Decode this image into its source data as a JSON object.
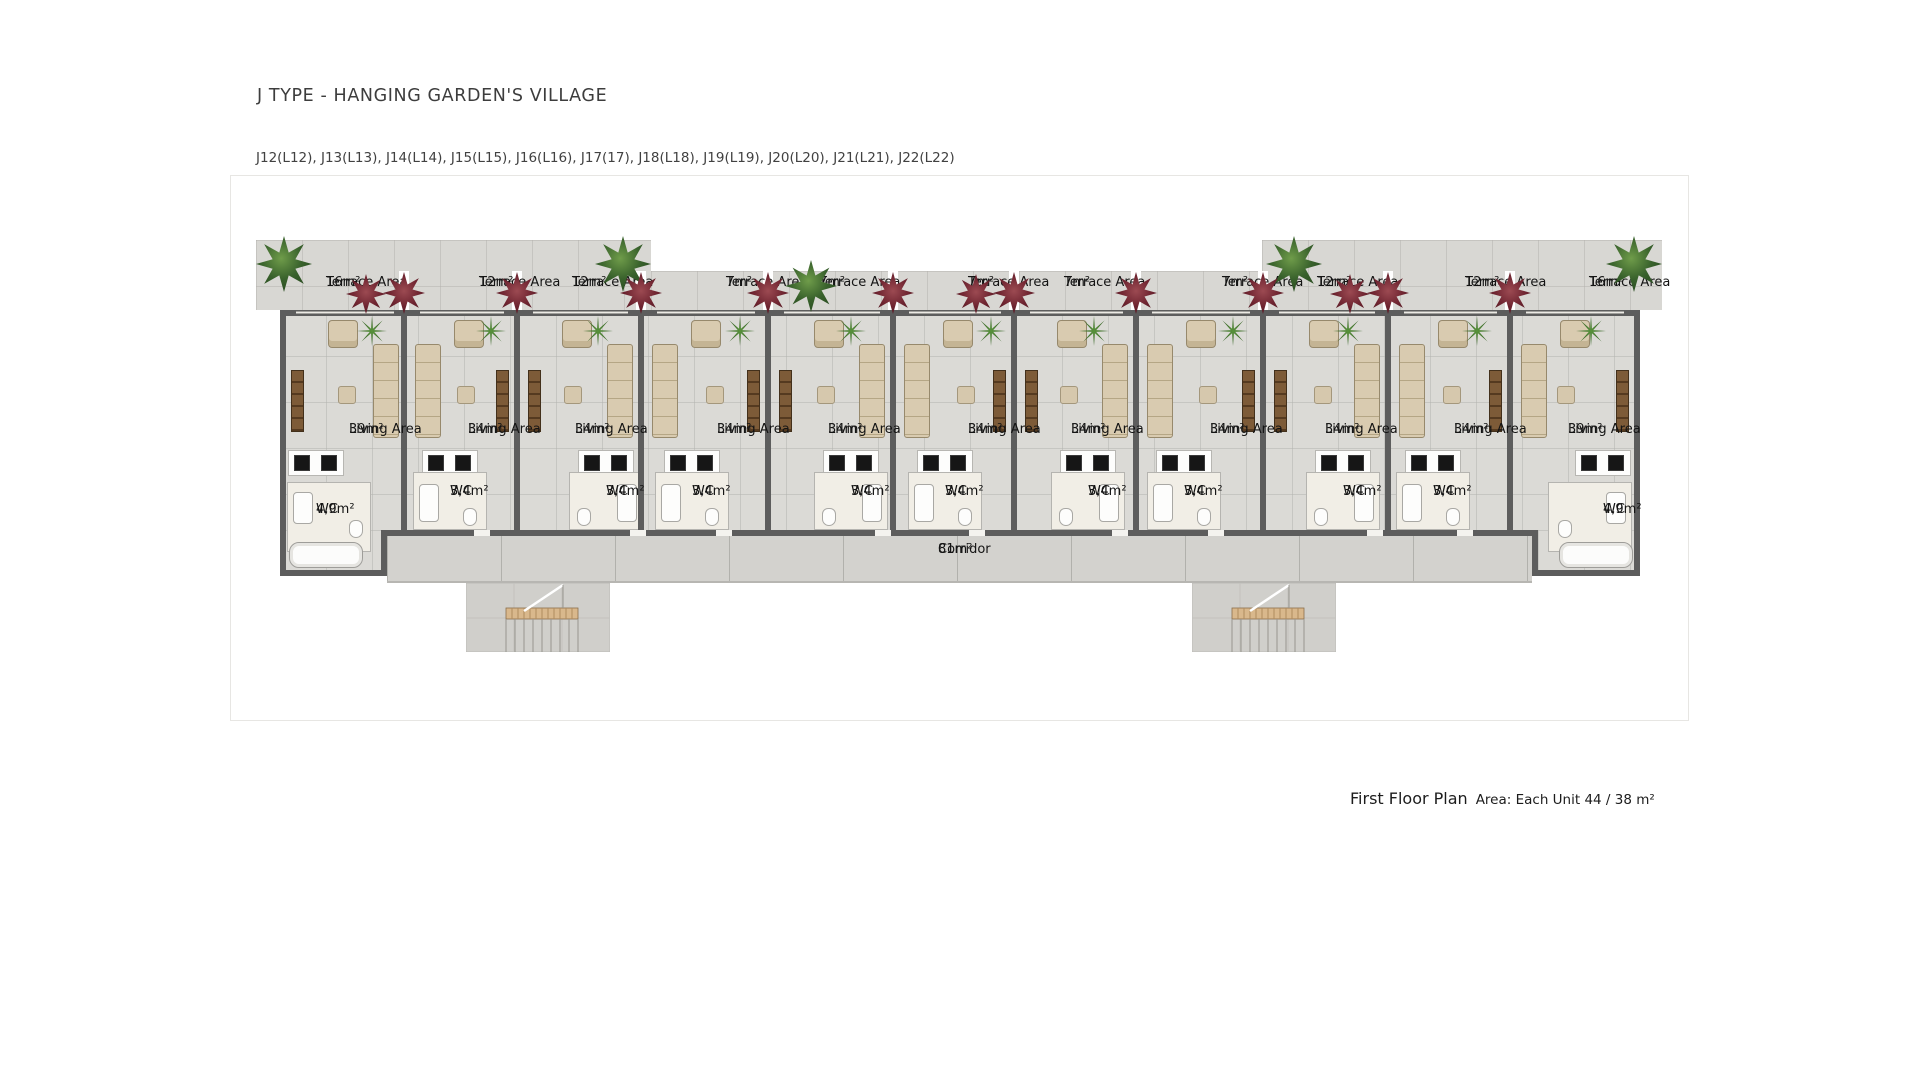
{
  "page": {
    "title": "J TYPE - HANGING GARDEN'S VILLAGE",
    "subtitle": "J12(L12), J13(L13), J14(L14), J15(L15), J16(L16), J17(17), J18(L18), J19(L19), J20(L20), J21(L21), J22(L22)",
    "footer": {
      "title": "First Floor Plan",
      "detail": "Area: Each Unit 44 / 38 m²"
    }
  },
  "plan": {
    "terrace_label": "Terrace Area",
    "living_label": "Living Area",
    "wc_label": "WC",
    "corridor": {
      "area": "81m²",
      "label": "Corridor"
    },
    "units": [
      {
        "terrace": "16m²",
        "living": "39m²",
        "wc": "4,9m²"
      },
      {
        "terrace": "12m²",
        "living": "34m²",
        "wc": "3,4m²"
      },
      {
        "terrace": "12m²",
        "living": "34m²",
        "wc": "3,4m²"
      },
      {
        "terrace": "7m²",
        "living": "34m²",
        "wc": "3,4m²"
      },
      {
        "terrace": "7m²",
        "living": "34m²",
        "wc": "3,4m²"
      },
      {
        "terrace": "7m²",
        "living": "34m²",
        "wc": "3,4m²"
      },
      {
        "terrace": "7m²",
        "living": "34m²",
        "wc": "3,4m²"
      },
      {
        "terrace": "7m²",
        "living": "34m²",
        "wc": "3,4m²"
      },
      {
        "terrace": "12m²",
        "living": "34m²",
        "wc": "3,4m²"
      },
      {
        "terrace": "12m²",
        "living": "34m²",
        "wc": "3,4m²"
      },
      {
        "terrace": "16m²",
        "living": "39m²",
        "wc": "4,9m²"
      }
    ],
    "colors": {
      "wall": "#5d5d5d",
      "floor": "#dbdad6",
      "roof": "#d8d7d3",
      "corridor": "#d3d2ce",
      "plant_green": "#39622c",
      "plant_red": "#6e2430",
      "sofa_beige": "#d9cbb0",
      "stair_landing": "#d9b88c"
    }
  }
}
